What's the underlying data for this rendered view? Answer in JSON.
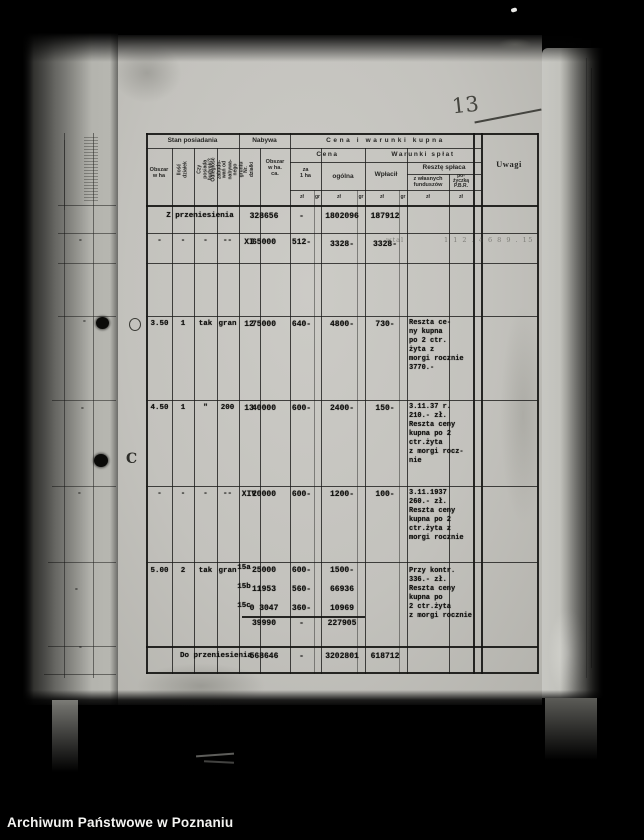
{
  "watermark": "Archiwum Państwowe w Poznaniu",
  "handwritten": {
    "page_number": "13",
    "margin_letter": "C",
    "scribble_a": "wtal",
    "scribble_b": "1 1 2 . 4 6 8 9 . 15"
  },
  "left_page": {
    "dashes": [
      "-",
      "-",
      "-",
      "-",
      "-",
      "-"
    ]
  },
  "table": {
    "groups": {
      "stan": "Stan posiadania",
      "nabywa": "Nabywa",
      "cena_warunki": "Cena i warunki kupna",
      "cena": "Cena",
      "warunki": "Warunki spłat",
      "reszte": "Resztę spłaca",
      "uwagi": "Uwagi"
    },
    "columns": {
      "obszar": "Obszar\nw ha",
      "ilosc": "Ilość działek",
      "budynki": "Czy posiada\nbudynki?",
      "odleglosc": "Odległość zabudo-\nwań od nabywa-\nnego gruntu",
      "nr": "Nr. działki",
      "obszar_ca": "Obszar\nw ha.\nca.",
      "za_1ha": "za\n1 ha",
      "ogolna": "ogólna",
      "wplacil": "Wpłacił",
      "z_wlasnych": "z własnych\nfunduszów",
      "pozyczka": "po-\nżyczką\nP.B.R.",
      "zl": "zł",
      "gr": "gr"
    },
    "rows": {
      "carry_in": {
        "label": "Z przeniesienia",
        "plot_area": "328656",
        "per_ha": "-",
        "total": "1802096",
        "paid": "187912"
      },
      "r1": {
        "area": "-",
        "plots": "-",
        "buildings": "-",
        "distance": "--",
        "nr": "XI",
        "plot_area": "65000",
        "per_ha": "512-",
        "total": "3328-",
        "paid": "3328-"
      },
      "r2": {
        "area": "3.50",
        "plots": "1",
        "buildings": "tak",
        "distance": "gran",
        "nr": "12",
        "plot_area": "75000",
        "per_ha": "640-",
        "total": "4800-",
        "paid": "730-",
        "note": "Reszta ce-\nny kupna\npo 2 ctr.\nżyta z\nmorgi rocznie\n3770.-"
      },
      "r3": {
        "area": "4.50",
        "plots": "1",
        "buildings": "\"",
        "distance": "200",
        "nr": "13",
        "plot_area": "40000",
        "per_ha": "600-",
        "total": "2400-",
        "paid": "150-",
        "note": "3.11.37 r.\n210.- zł.\nReszta ceny\nkupna po 2\nctr.żyta\nz morgi rocz-\nnie"
      },
      "r4": {
        "area": "-",
        "plots": "-",
        "buildings": "-",
        "distance": "--",
        "nr": "XIV",
        "plot_area": "20000",
        "per_ha": "600-",
        "total": "1200-",
        "paid": "100-",
        "note": "3.11.1937\n260.- zł.\nReszta ceny\nkupna po 2\nctr.żyta z\nmorgi rocznie"
      },
      "r5": {
        "area": "5.00",
        "plots": "2",
        "buildings": "tak",
        "distance": "gran",
        "parcels": [
          {
            "nr": "15a",
            "plot_area": "25000",
            "per_ha": "600-",
            "total": "1500-"
          },
          {
            "nr": "15b",
            "plot_area": "11953",
            "per_ha": "560-",
            "total": "66936"
          },
          {
            "nr": "15c",
            "plot_area": "0 3047",
            "per_ha": "360-",
            "total": "10969"
          }
        ],
        "sum": {
          "plot_area": "39990",
          "per_ha": "-",
          "total": "227905"
        },
        "note": "Przy kontr.\n336.- zł.\nReszta ceny\nkupna po\n2 ctr.żyta\nz morgi rocznie"
      },
      "carry_out": {
        "label": "Do przeniesienia",
        "plot_area": "568646",
        "per_ha": "-",
        "total": "3202801",
        "paid": "618712"
      }
    }
  }
}
